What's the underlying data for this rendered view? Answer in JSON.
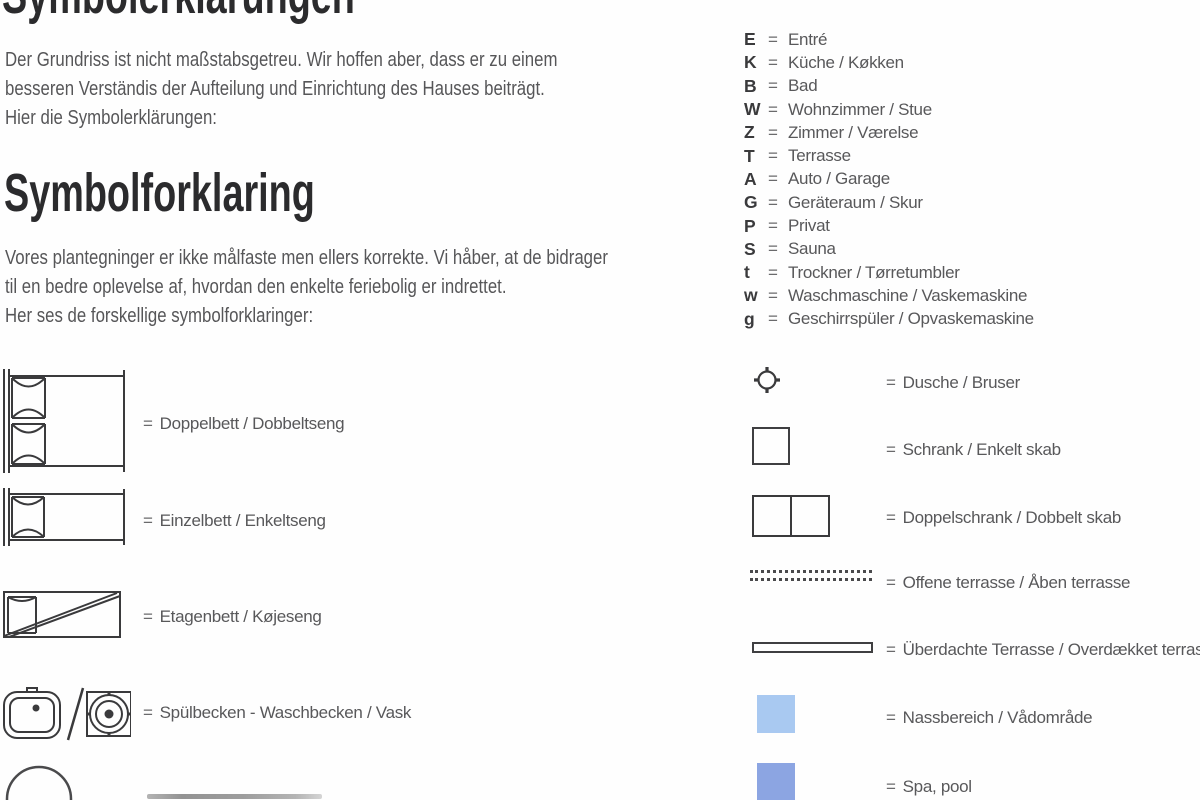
{
  "page": {
    "title_de": "Symbolerklärungen",
    "title_da": "Symbolforklaring",
    "intro_de": {
      "line1": "Der Grundriss ist nicht maßstabsgetreu. Wir hoffen aber, dass er zu einem",
      "line2": "besseren Verständis der Aufteilung und Einrichtung des Hauses beiträgt.",
      "line3": "Hier die Symbolerklärungen:"
    },
    "intro_da": {
      "line1": "Vores plantegninger er ikke målfaste men ellers korrekte. Vi håber, at de bidrager",
      "line2": "til en bedre oplevelse af, hvordan den enkelte feriebolig er indrettet.",
      "line3": "Her ses de forskellige symbolforklaringer:"
    }
  },
  "equals": "=",
  "letter_legend": [
    {
      "key": "E",
      "value": "Entré"
    },
    {
      "key": "K",
      "value": "Küche / Køkken"
    },
    {
      "key": "B",
      "value": "Bad"
    },
    {
      "key": "W",
      "value": "Wohnzimmer / Stue"
    },
    {
      "key": "Z",
      "value": "Zimmer / Værelse"
    },
    {
      "key": "T",
      "value": "Terrasse"
    },
    {
      "key": "A",
      "value": "Auto / Garage"
    },
    {
      "key": "G",
      "value": "Geräteraum / Skur"
    },
    {
      "key": "P",
      "value": "Privat"
    },
    {
      "key": "S",
      "value": "Sauna"
    },
    {
      "key": "t",
      "value": "Trockner / Tørretumbler"
    },
    {
      "key": "w",
      "value": "Waschmaschine / Vaskemaskine"
    },
    {
      "key": "g",
      "value": "Geschirrspüler / Opvaskemaskine"
    }
  ],
  "symbol_legend_left": [
    {
      "icon": "double-bed-icon",
      "label": "Doppelbett / Dobbeltseng"
    },
    {
      "icon": "single-bed-icon",
      "label": "Einzelbett / Enkeltseng"
    },
    {
      "icon": "bunk-bed-icon",
      "label": "Etagenbett / Køjeseng"
    },
    {
      "icon": "sink-washbasin-icon",
      "label": "Spülbecken - Waschbecken / Vask"
    }
  ],
  "symbol_legend_right": [
    {
      "icon": "shower-icon",
      "label": "Dusche / Bruser"
    },
    {
      "icon": "single-cabinet-icon",
      "label": "Schrank / Enkelt skab"
    },
    {
      "icon": "double-cabinet-icon",
      "label": "Doppelschrank / Dobbelt skab"
    },
    {
      "icon": "open-terrace-icon",
      "label": "Offene terrasse / Åben terrasse"
    },
    {
      "icon": "covered-terrace-icon",
      "label": "Überdachte Terrasse / Overdækket terrasse"
    },
    {
      "icon": "wet-area-icon",
      "label": "Nassbereich / Vådområde"
    },
    {
      "icon": "spa-pool-icon",
      "label": "Spa, pool"
    }
  ],
  "colors": {
    "wet_area": "#a9c9f1",
    "spa_pool": "#8ca5e2",
    "line": "#3a3a3c",
    "text": "#58585a",
    "heading": "#2b2b2d"
  }
}
